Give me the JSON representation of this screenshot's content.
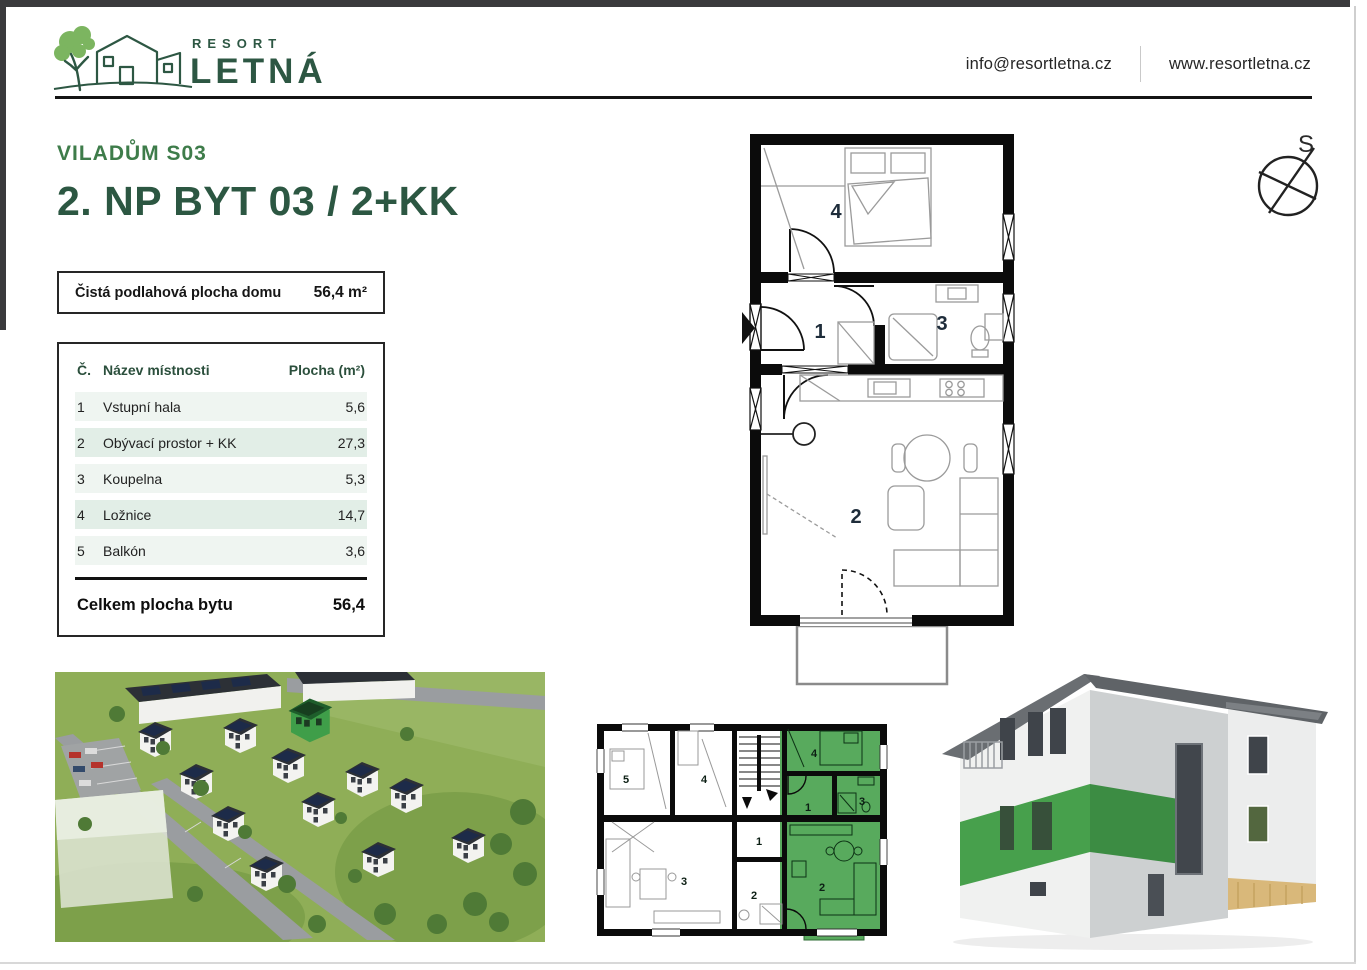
{
  "header": {
    "logo": {
      "top": "RESORT",
      "main": "LETNÁ"
    },
    "contact_email": "info@resortletna.cz",
    "website": "www.resortletna.cz"
  },
  "title": {
    "project": "VILADŮM S03",
    "apartment": "2. NP BYT 03 / 2+KK"
  },
  "summary": {
    "label": "Čistá podlahová plocha domu",
    "value": "56,4 m²"
  },
  "rooms_table": {
    "col_number": "Č.",
    "col_name": "Název místnosti",
    "col_area": "Plocha (m²)",
    "rows": [
      {
        "number": "1",
        "name": "Vstupní hala",
        "area": "5,6"
      },
      {
        "number": "2",
        "name": "Obývací prostor + KK",
        "area": "27,3"
      },
      {
        "number": "3",
        "name": "Koupelna",
        "area": "5,3"
      },
      {
        "number": "4",
        "name": "Ložnice",
        "area": "14,7"
      },
      {
        "number": "5",
        "name": "Balkón",
        "area": "3,6"
      }
    ],
    "total_label": "Celkem plocha bytu",
    "total_value": "56,4"
  },
  "compass": {
    "north_label": "S"
  },
  "main_plan": {
    "labels": {
      "hall": "1",
      "living": "2",
      "bathroom": "3",
      "bedroom": "4"
    }
  },
  "overview_plan": {
    "left": {
      "r5": "5",
      "r4": "4",
      "r3": "3",
      "r1": "1",
      "r2": "2"
    },
    "green": {
      "r4": "4",
      "r1": "1",
      "r3": "3",
      "r2": "2"
    }
  },
  "colors": {
    "brand_dark_green": "#2d5743",
    "brand_green": "#3e7c4a",
    "leaf_green": "#7cb560",
    "highlight_green": "#58aa5d",
    "facade_green": "#47a04c",
    "table_row_light": "#eff5f1",
    "table_row_dark": "#e2eee7",
    "wall_black": "#0b0b0b"
  }
}
